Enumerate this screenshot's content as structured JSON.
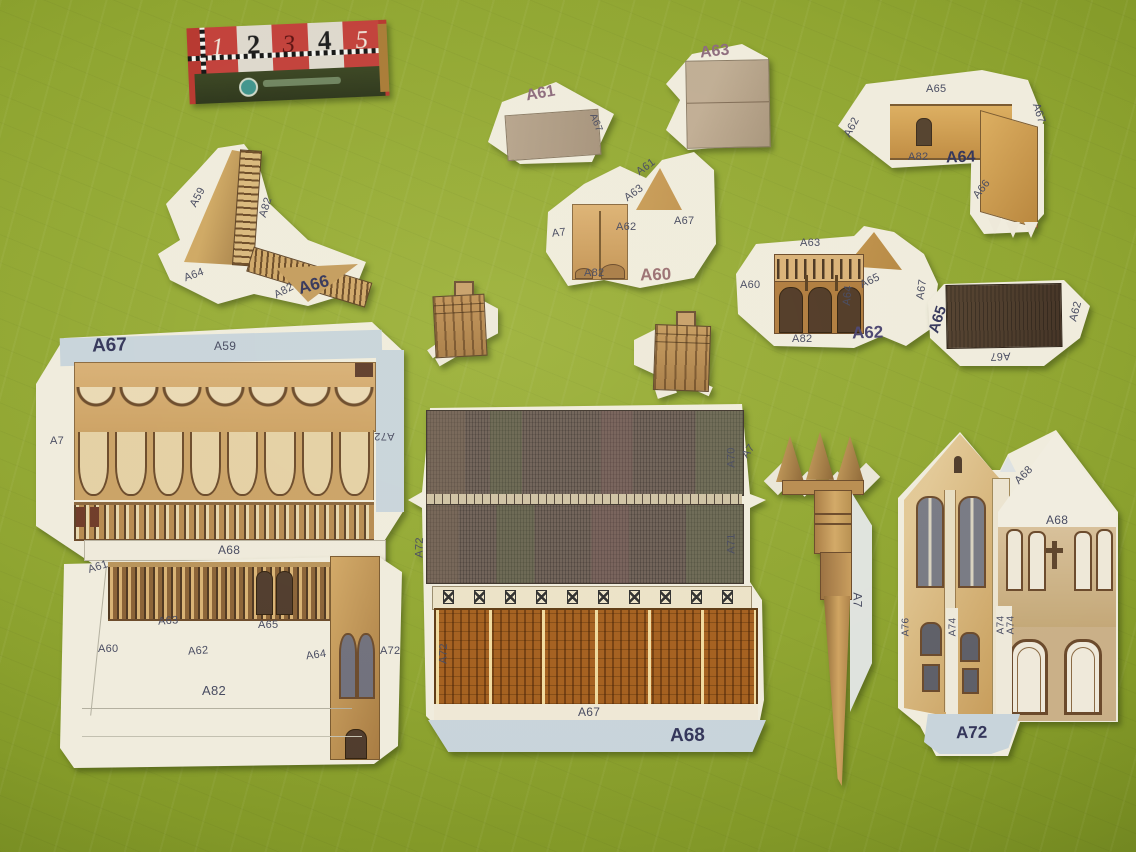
{
  "palette": {
    "background_green": "#8ea42f",
    "paper_cream": "#f0ecdd",
    "flap_blue_grey": "#c8d4db",
    "tan_wall": "#d3aa6d",
    "dark_brown": "#4a392b",
    "roof_grey_brown": "#6e6057",
    "orange_panel": "#a45f1e",
    "label_ink": "#474a60",
    "bold_label_ink": "#33355a",
    "mauve_label_ink": "#8d6b7d",
    "matchbox_red": "#c2403a"
  },
  "matchbox": {
    "ruler": [
      "1",
      "2",
      "3",
      "4",
      "5"
    ]
  },
  "pieces": {
    "a61_gable": {
      "name": "A61",
      "flap_right": "A67"
    },
    "a63_wall": {
      "name": "A63"
    },
    "a64_wall": {
      "name": "A64",
      "flap_top": "A65",
      "flap_left": "A62",
      "flap_bottom": "A82",
      "flap_right": "A67",
      "flap_arm": "A66"
    },
    "a66_roof": {
      "name": "A66",
      "flap_a59": "A59",
      "flap_a82a": "A82",
      "flap_a64": "A64",
      "flap_a82b": "A82"
    },
    "a60_wall": {
      "name": "A60",
      "flap_a61": "A61",
      "flap_a63": "A63",
      "flap_a7": "A7",
      "flap_a62": "A62",
      "flap_a67": "A67",
      "flap_a82": "A82"
    },
    "a62_arcade": {
      "name": "A62",
      "flap_top": "A63",
      "flap_left": "A60",
      "flap_bottom": "A82",
      "flap_a64": "A64",
      "flap_a65": "A65",
      "flap_a67": "A67"
    },
    "a65_roof": {
      "name": "A65",
      "flap_right": "A62",
      "flap_bottom": "A67"
    },
    "a67_facade": {
      "name": "A67",
      "flap_top": "A59",
      "flap_left": "A7",
      "flap_right": "A72",
      "flap_bottom": "A68"
    },
    "a82_base": {
      "flap_a61": "A61",
      "flap_a60": "A60",
      "flap_a63": "A63",
      "flap_a62": "A62",
      "flap_a65": "A65",
      "flap_a64": "A64",
      "label_a82": "A82",
      "flap_a72": "A72"
    },
    "a68_roof": {
      "name": "A68",
      "flap_a70": "A70",
      "flap_a7": "A7",
      "flap_a71": "A71",
      "flap_a72_top": "A72",
      "flap_a72_bottom": "A72",
      "label_a67": "A67"
    },
    "a7_spire": {
      "flap": "A7"
    },
    "a72_facade": {
      "name": "A72",
      "flap_a68_diag": "A68",
      "flap_a68_horiz": "A68",
      "flap_a76": "A76",
      "flap_a74a": "A74",
      "flap_a74b": "A74",
      "flap_a74c": "A74"
    }
  }
}
